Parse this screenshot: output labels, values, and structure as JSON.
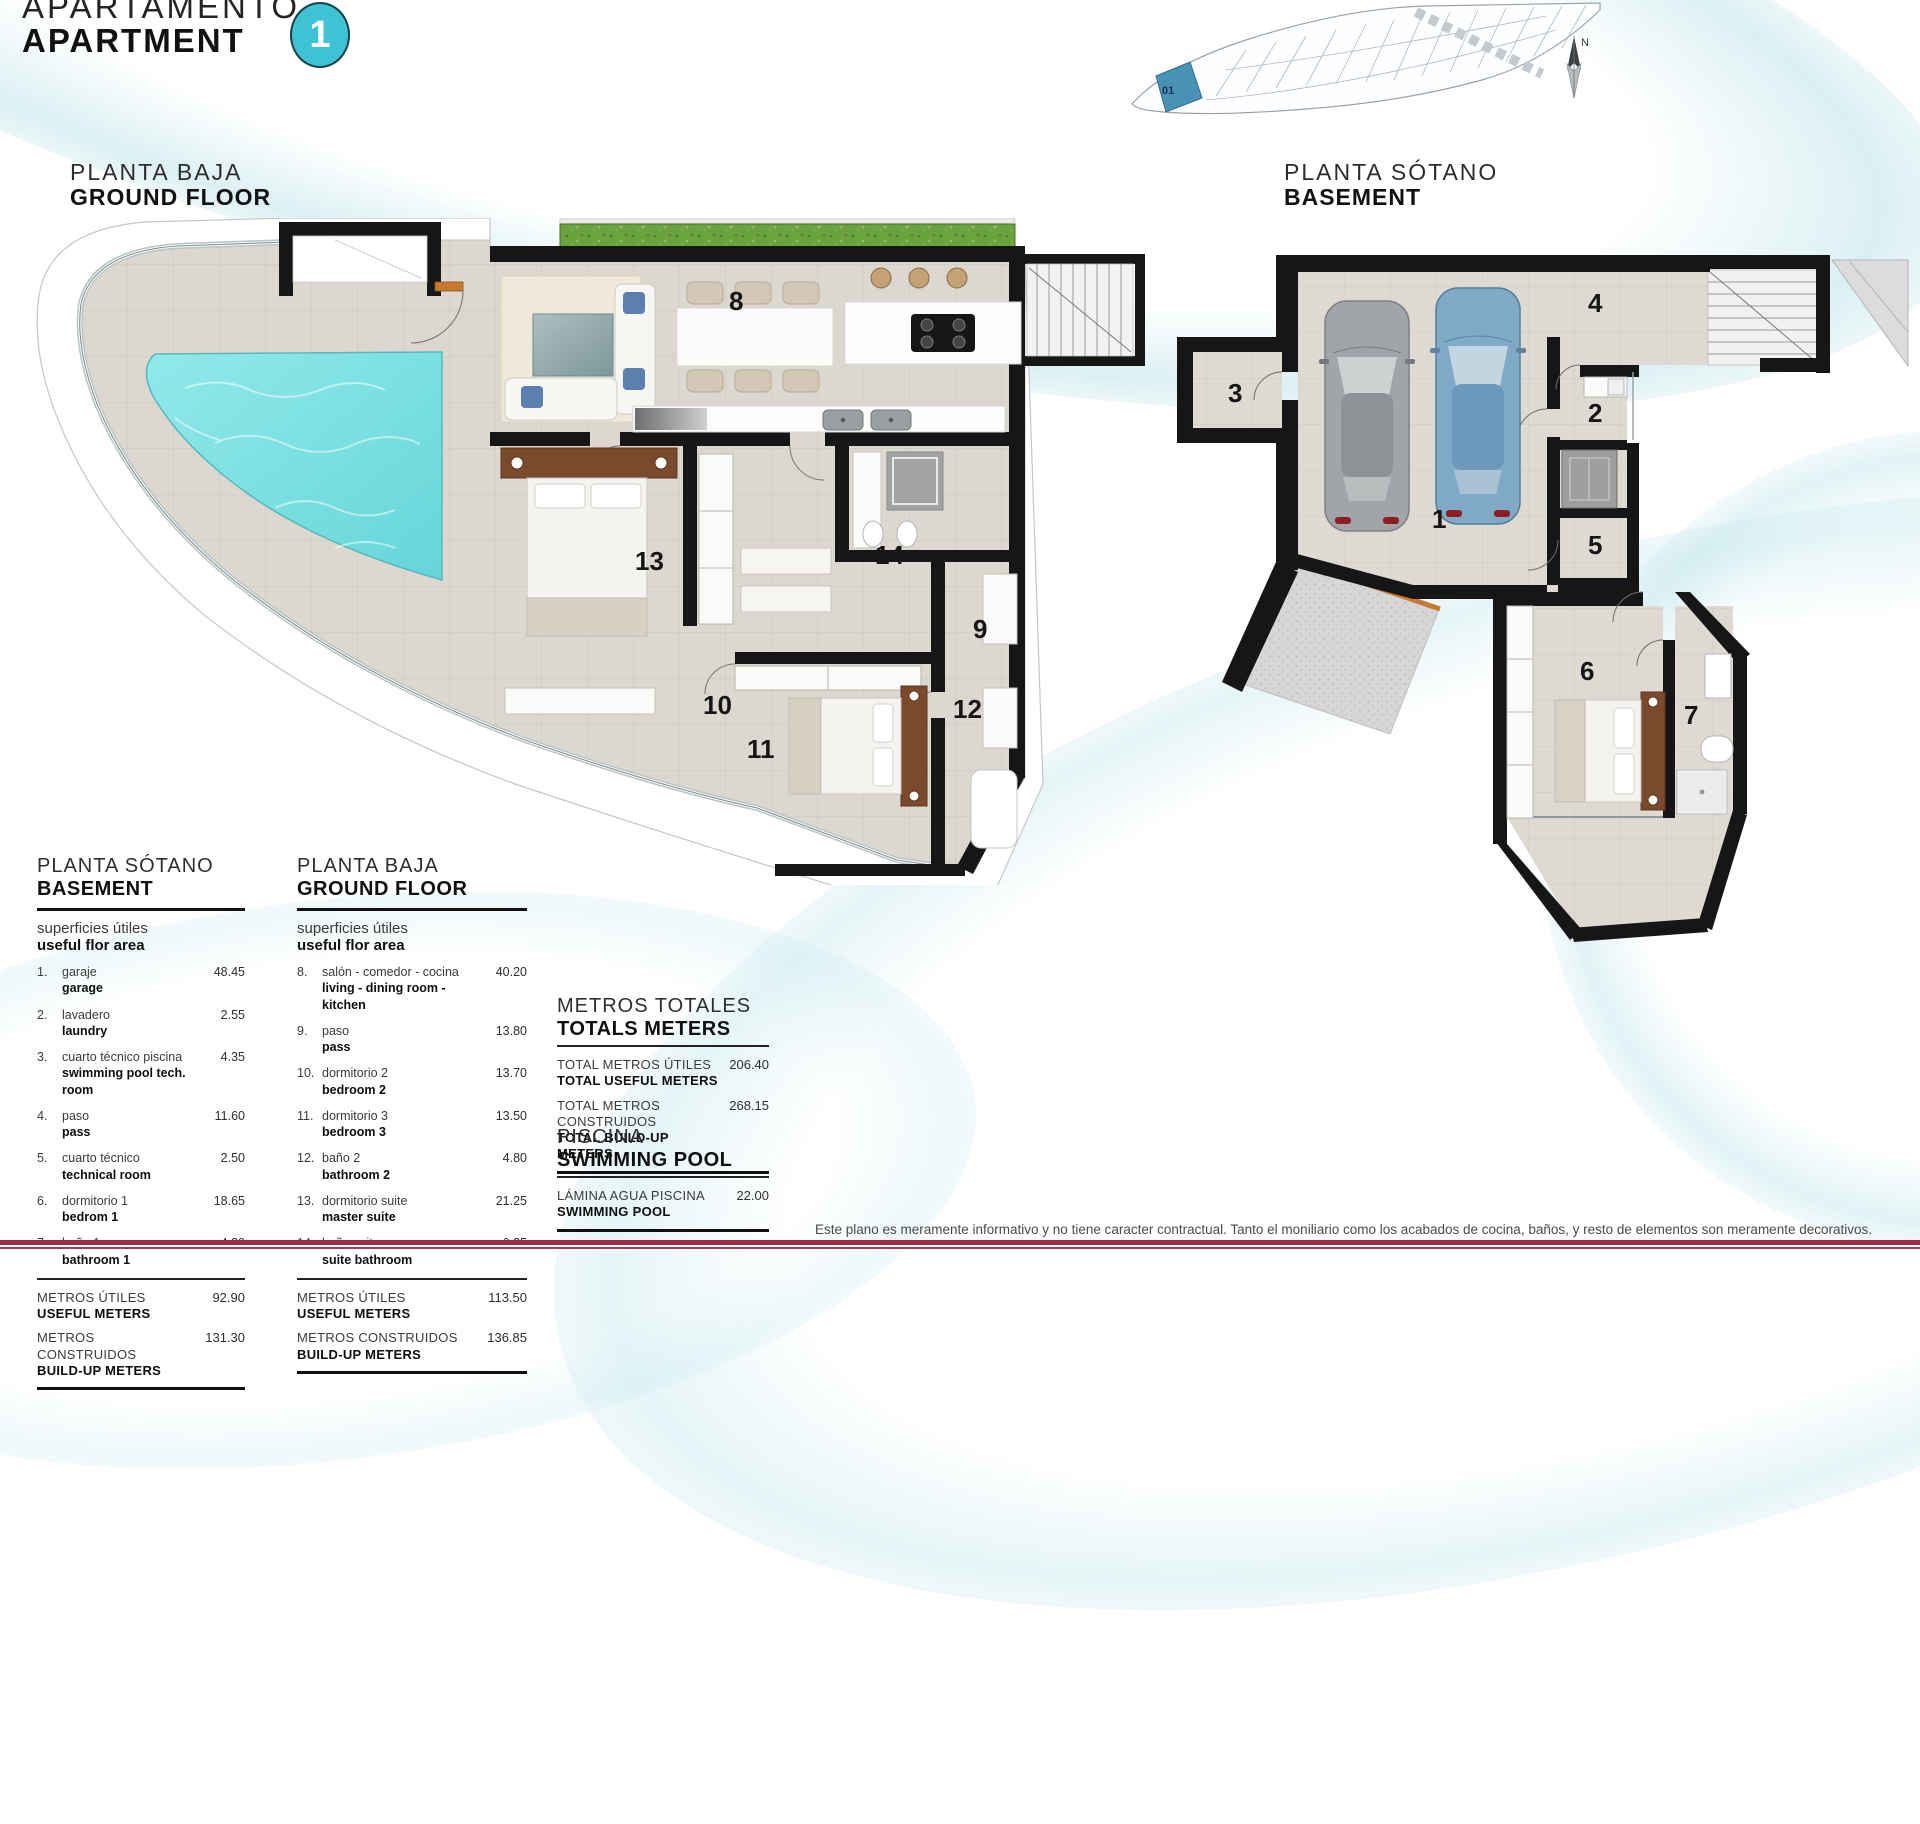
{
  "header": {
    "title_es": "APARTAMENTO",
    "title_en": "APARTMENT",
    "unit_badge": "1"
  },
  "site_plan": {
    "unit_label": "01",
    "north_label": "N"
  },
  "plans": {
    "ground": {
      "label_es": "PLANTA BAJA",
      "label_en": "GROUND FLOOR",
      "rooms": [
        "8",
        "9",
        "10",
        "11",
        "12",
        "13",
        "14"
      ]
    },
    "basement": {
      "label_es": "PLANTA SÓTANO",
      "label_en": "BASEMENT",
      "rooms": [
        "1",
        "2",
        "3",
        "4",
        "5",
        "6",
        "7"
      ]
    }
  },
  "tables": {
    "basement": {
      "title_es": "PLANTA SÓTANO",
      "title_en": "BASEMENT",
      "subtitle_es": "superficies útiles",
      "subtitle_en": "useful flor area",
      "rows": [
        {
          "num": "1.",
          "es": "garaje",
          "en": "garage",
          "val": "48.45"
        },
        {
          "num": "2.",
          "es": "lavadero",
          "en": "laundry",
          "val": "2.55"
        },
        {
          "num": "3.",
          "es": "cuarto técnico piscina",
          "en": "swimming pool tech. room",
          "val": "4.35"
        },
        {
          "num": "4.",
          "es": "paso",
          "en": "pass",
          "val": "11.60"
        },
        {
          "num": "5.",
          "es": "cuarto técnico",
          "en": "technical room",
          "val": "2.50"
        },
        {
          "num": "6.",
          "es": "dormitorio 1",
          "en": "bedrom 1",
          "val": "18.65"
        },
        {
          "num": "7.",
          "es": "baño 1",
          "en": "bathroom 1",
          "val": "4.80"
        }
      ],
      "totals": [
        {
          "es": "METROS ÚTILES",
          "en": "USEFUL METERS",
          "val": "92.90"
        },
        {
          "es": "METROS CONSTRUIDOS",
          "en": "BUILD-UP METERS",
          "val": "131.30"
        }
      ]
    },
    "ground": {
      "title_es": "PLANTA BAJA",
      "title_en": "GROUND FLOOR",
      "subtitle_es": "superficies útiles",
      "subtitle_en": "useful flor area",
      "rows": [
        {
          "num": "8.",
          "es": "salón - comedor - cocina",
          "en": "living - dining room - kitchen",
          "val": "40.20"
        },
        {
          "num": "9.",
          "es": "paso",
          "en": "pass",
          "val": "13.80"
        },
        {
          "num": "10.",
          "es": "dormitorio 2",
          "en": "bedroom 2",
          "val": "13.70"
        },
        {
          "num": "11.",
          "es": "dormitorio 3",
          "en": "bedroom 3",
          "val": "13.50"
        },
        {
          "num": "12.",
          "es": "baño 2",
          "en": "bathroom 2",
          "val": "4.80"
        },
        {
          "num": "13.",
          "es": "dormitorio suite",
          "en": "master suite",
          "val": "21.25"
        },
        {
          "num": "14.",
          "es": "baño suite",
          "en": "suite bathroom",
          "val": "6.25"
        }
      ],
      "totals": [
        {
          "es": "METROS ÚTILES",
          "en": "USEFUL METERS",
          "val": "113.50"
        },
        {
          "es": "METROS CONSTRUIDOS",
          "en": "BUILD-UP METERS",
          "val": "136.85"
        }
      ]
    },
    "grand": {
      "title_es": "METROS TOTALES",
      "title_en": "TOTALS METERS",
      "rows": [
        {
          "es": "TOTAL METROS ÚTILES",
          "en": "TOTAL USEFUL METERS",
          "val": "206.40"
        },
        {
          "es": "TOTAL METROS CONSTRUIDOS",
          "en": "TOTAL BUILD-UP METERS",
          "val": "268.15"
        }
      ]
    },
    "pool": {
      "title_es": "PISCINA",
      "title_en": "SWIMMING POOL",
      "rows": [
        {
          "es": "LÁMINA AGUA PISCINA",
          "en": "SWIMMING POOL",
          "val": "22.00"
        }
      ]
    }
  },
  "footer": {
    "disclaimer": "Este plano es meramente informativo y no tiene caracter contractual. Tanto el moniliario como los acabados de cocina, baños, y resto de elementos son meramente decorativos."
  },
  "colors": {
    "accent_teal": "#3fc2d3",
    "pool_water": "#7de1e3",
    "floor_beige": "#dcd8d0",
    "wall_black": "#161616",
    "site_highlight": "#4a92b5",
    "maroon_line": "#9b2c44",
    "wood_accent": "#c9792e",
    "headboard_brown": "#7b4a2d",
    "grass_green": "#6aa23d"
  }
}
